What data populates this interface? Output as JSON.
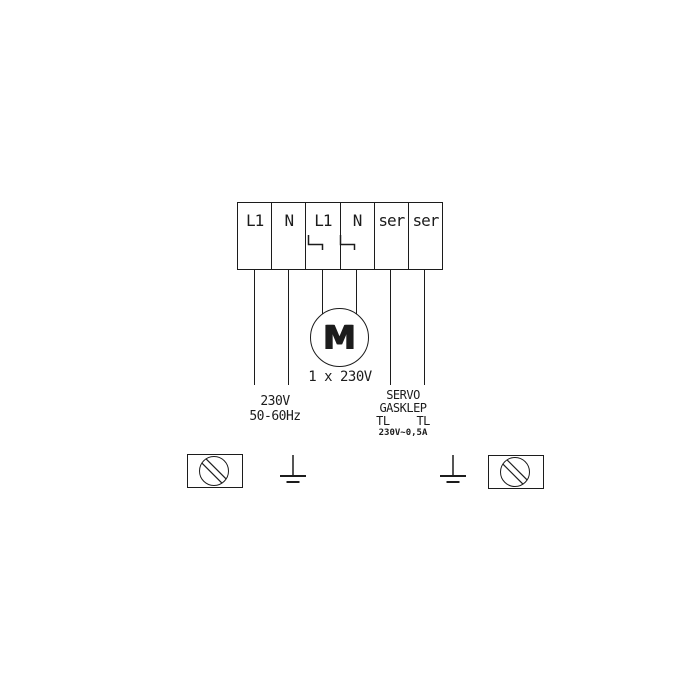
{
  "terminal_block": {
    "cells": [
      {
        "label": "L1"
      },
      {
        "label": "N"
      },
      {
        "label": "L1"
      },
      {
        "label": "N"
      },
      {
        "label": "ser"
      },
      {
        "label": "ser"
      }
    ]
  },
  "motor": {
    "letter": "M",
    "caption": "1 x 230V"
  },
  "mains_label": {
    "voltage": "230V",
    "frequency": "50-60Hz"
  },
  "servo_label": {
    "line1": "SERVO",
    "line2": "GASKLEP",
    "line3": "TL    TL",
    "line4": "230V~0,5A"
  },
  "colors": {
    "ink": "#1c1c1c",
    "background": "#ffffff"
  }
}
